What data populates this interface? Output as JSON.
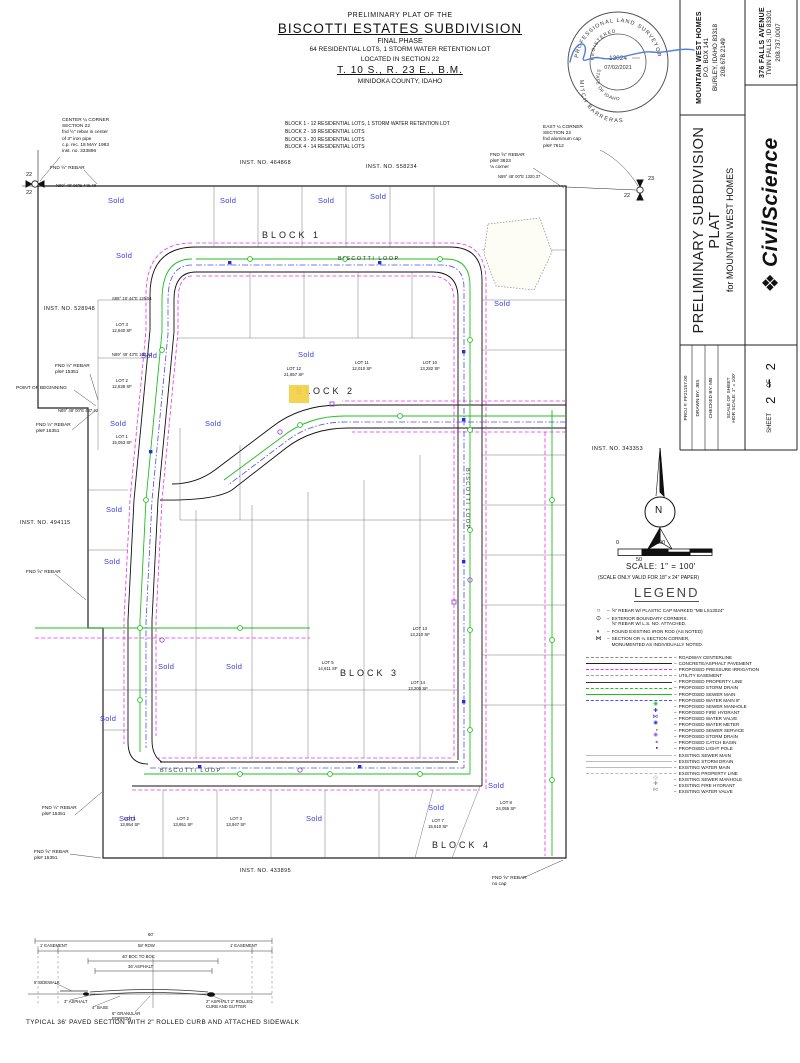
{
  "colors": {
    "sold_blue": "#3a3aee",
    "irrigation_magenta": "#e833e8",
    "sewer_green": "#1fbf1f",
    "water_blue": "#4d4de8",
    "storm_purple": "#9b4fd6",
    "existing_gray": "#bbbbbb",
    "highlight_yellow": "#f2d24b",
    "signature_blue": "#4f7fd9"
  },
  "title_block": {
    "prefix": "PRELIMINARY PLAT OF THE",
    "name": "BISCOTTI ESTATES SUBDIVISION",
    "phase": "FINAL PHASE",
    "lots_line": "64 RESIDENTIAL LOTS, 1 STORM WATER RETENTION LOT",
    "located_line": "LOCATED IN SECTION 22",
    "township_line": "T. 10 S., R. 23 E., B.M.",
    "county_line": "MINIDOKA COUNTY, IDAHO"
  },
  "blocks_summary": "BLOCK 1 - 12 RESIDENTIAL LOTS, 1 STORM WATER RETENTION LOT\nBLOCK 2 - 18 RESIDENTIAL LOTS\nBLOCK 3 - 20 RESIDENTIAL LOTS\nBLOCK 4 - 14 RESIDENTIAL LOTS",
  "seal": {
    "ring_top": "PROFESSIONAL LAND SURVEYOR",
    "registered": "REGISTERED",
    "number": "13024",
    "date": "07/02/2021",
    "state": "STATE OF IDAHO",
    "name": "MITCH BARRERAS"
  },
  "sidebar": {
    "client_name": "MOUNTAIN WEST HOMES",
    "client_addr1": "P.O. BOX 141",
    "client_addr2": "BURLEY, IDAHO 83318",
    "client_phone": "208.678.2149",
    "firm_addr1": "376 FALLS AVENUE",
    "firm_addr2": "TWIN FALLS, ID 83301",
    "firm_phone": "208.737.0007",
    "logo_text": "CivilScience",
    "sheet_title": "PRELIMINARY SUBDIVISION PLAT",
    "sheet_for": "for MOUNTAIN WEST HOMES",
    "proj": "PROJ #: FF21157.00",
    "drawn": "DRAWN BY: JBS",
    "checked": "CHECKED BY: MB",
    "scale1": "SCALE OF SHEET",
    "scale2": "HOR SCALE: 1\" = 100'",
    "sheet_word": "SHEET",
    "sheet_no": "2",
    "of_word": "OF",
    "sheet_total": "2"
  },
  "scale_bar": {
    "zero": "0",
    "fifty": "50",
    "hundred": "100",
    "scale_text": "SCALE: 1\" = 100'",
    "valid_text": "(SCALE ONLY VALID FOR 18\" x 24\" PAPER)"
  },
  "legend": {
    "title": "LEGEND",
    "markers": [
      {
        "icon": "○",
        "label": "⅝\" REBAR W/ PLASTIC CAP MARKED \"MB LS13024\""
      },
      {
        "icon": "⊙",
        "label": "EXTERIOR BOUNDARY CORNERS.\n⅝\" REBAR W/ L.S. NO. ATTACHED."
      },
      {
        "icon": "◐",
        "label": "FOUND EXISTING IRON ROD (AS NOTED)"
      },
      {
        "icon": "⋈",
        "label": "SECTION OR ¼ SECTION CORNER,\nMONUMENTED AS INDIVIDUALLY NOTED."
      }
    ],
    "lines": [
      {
        "sw": "sw-centerline",
        "label": "ROADWAY CENTERLINE"
      },
      {
        "sw": "sw-pavement",
        "label": "CONCRETE/ASPHALT PAVEMENT"
      },
      {
        "sw": "sw-pirr",
        "label": "PROPOSED PRESSURE IRRIGATION"
      },
      {
        "sw": "sw-easement",
        "label": "UTILITY EASEMENT"
      },
      {
        "sw": "sw-prop",
        "label": "PROPOSED PROPERTY LINE"
      },
      {
        "sw": "sw-storm",
        "label": "PROPOSED STORM DRAIN"
      },
      {
        "sw": "sw-sewer",
        "label": "PROPOSED SEWER MAIN"
      },
      {
        "sw": "sw-water",
        "label": "PROPOSED WATER MAIN 8\""
      },
      {
        "sw": "ic-smh",
        "label": "PROPOSED SEWER MANHOLE"
      },
      {
        "sw": "ic-hyd",
        "label": "PROPOSED FIRE HYDRANT"
      },
      {
        "sw": "ic-wv",
        "label": "PROPOSED WATER VALVE"
      },
      {
        "sw": "ic-wm",
        "label": "PROPOSED WATER METER"
      },
      {
        "sw": "ic-ss",
        "label": "PROPOSED SEWER SERVICE"
      },
      {
        "sw": "ic-stmh",
        "label": "PROPOSED STORM DRAIN"
      },
      {
        "sw": "ic-cb",
        "label": "PROPOSED CATCH BASIN"
      },
      {
        "sw": "ic-lp",
        "label": "PROPOSED LIGHT POLE"
      },
      {
        "sw": "sw-ex",
        "label": "EXISTING SEWER MAIN"
      },
      {
        "sw": "sw-ex",
        "label": "EXISTING STORM DRAIN"
      },
      {
        "sw": "sw-ex",
        "label": "EXISTING WATER MAIN"
      },
      {
        "sw": "sw-exd",
        "label": "EXISTING PROPERTY LINE"
      },
      {
        "sw": "ic-exmh",
        "label": "EXISTING SEWER MANHOLE"
      },
      {
        "sw": "ic-exhyd",
        "label": "EXISTING FIRE HYDRANT"
      },
      {
        "sw": "ic-exwv",
        "label": "EXISTING WATER VALVE"
      }
    ]
  },
  "map": {
    "labels": [
      {
        "text": "BISCOTTI LOOP",
        "x": 338,
        "y": 256,
        "cls": "street"
      },
      {
        "text": "BISCOTTI LOOP",
        "x": 463,
        "y": 468,
        "cls": "street-v"
      },
      {
        "text": "BISCOTTI LOOP",
        "x": 160,
        "y": 768,
        "cls": "street"
      },
      {
        "text": "BLOCK 1",
        "x": 262,
        "y": 230,
        "cls": "block"
      },
      {
        "text": "BLOCK 2",
        "x": 296,
        "y": 386,
        "cls": "block"
      },
      {
        "text": "BLOCK 3",
        "x": 340,
        "y": 668,
        "cls": "block"
      },
      {
        "text": "BLOCK 4",
        "x": 432,
        "y": 840,
        "cls": "block"
      },
      {
        "text": "INST. NO. 464868",
        "x": 240,
        "y": 160,
        "cls": "inst"
      },
      {
        "text": "INST. NO. 558234",
        "x": 366,
        "y": 164,
        "cls": "inst"
      },
      {
        "text": "INST. NO. 528948",
        "x": 44,
        "y": 306,
        "cls": "inst"
      },
      {
        "text": "INST. NO. 494115",
        "x": 20,
        "y": 520,
        "cls": "inst"
      },
      {
        "text": "INST. NO. 343353",
        "x": 592,
        "y": 446,
        "cls": "inst"
      },
      {
        "text": "INST. NO. 433895",
        "x": 240,
        "y": 868,
        "cls": "inst"
      },
      {
        "text": "Sold",
        "x": 108,
        "y": 196,
        "cls": "sold"
      },
      {
        "text": "Sold",
        "x": 220,
        "y": 196,
        "cls": "sold"
      },
      {
        "text": "Sold",
        "x": 318,
        "y": 196,
        "cls": "sold"
      },
      {
        "text": "Sold",
        "x": 370,
        "y": 192,
        "cls": "sold"
      },
      {
        "text": "Sold",
        "x": 116,
        "y": 251,
        "cls": "sold"
      },
      {
        "text": "Sold",
        "x": 494,
        "y": 299,
        "cls": "sold"
      },
      {
        "text": "Sold",
        "x": 298,
        "y": 350,
        "cls": "sold"
      },
      {
        "text": "Sold",
        "x": 141,
        "y": 351,
        "cls": "sold"
      },
      {
        "text": "Sold",
        "x": 110,
        "y": 419,
        "cls": "sold"
      },
      {
        "text": "Sold",
        "x": 205,
        "y": 419,
        "cls": "sold"
      },
      {
        "text": "Sold",
        "x": 106,
        "y": 505,
        "cls": "sold"
      },
      {
        "text": "Sold",
        "x": 104,
        "y": 557,
        "cls": "sold"
      },
      {
        "text": "Sold",
        "x": 158,
        "y": 662,
        "cls": "sold"
      },
      {
        "text": "Sold",
        "x": 226,
        "y": 662,
        "cls": "sold"
      },
      {
        "text": "Sold",
        "x": 100,
        "y": 714,
        "cls": "sold"
      },
      {
        "text": "Sold",
        "x": 119,
        "y": 814,
        "cls": "sold"
      },
      {
        "text": "Sold",
        "x": 306,
        "y": 814,
        "cls": "sold"
      },
      {
        "text": "Sold",
        "x": 428,
        "y": 803,
        "cls": "sold"
      },
      {
        "text": "Sold",
        "x": 488,
        "y": 781,
        "cls": "sold"
      },
      {
        "text": "LOT 3\n12,640 SF",
        "x": 112,
        "y": 322,
        "cls": "lot"
      },
      {
        "text": "LOT 2\n12,638 SF",
        "x": 112,
        "y": 378,
        "cls": "lot"
      },
      {
        "text": "LOT 1\n15,053 SF",
        "x": 112,
        "y": 434,
        "cls": "lot"
      },
      {
        "text": "LOT 12\n21,857 SF",
        "x": 284,
        "y": 366,
        "cls": "lot"
      },
      {
        "text": "LOT 11\n12,010 SF",
        "x": 352,
        "y": 360,
        "cls": "lot"
      },
      {
        "text": "LOT 10\n13,282 SF",
        "x": 420,
        "y": 360,
        "cls": "lot"
      },
      {
        "text": "LOT 5\n14,611 SF",
        "x": 318,
        "y": 660,
        "cls": "lot"
      },
      {
        "text": "LOT 13\n13,210 SF",
        "x": 410,
        "y": 626,
        "cls": "lot"
      },
      {
        "text": "LOT 14\n13,200 SF",
        "x": 408,
        "y": 680,
        "cls": "lot"
      },
      {
        "text": "LOT 1\n13,954 SF",
        "x": 120,
        "y": 816,
        "cls": "lot"
      },
      {
        "text": "LOT 2\n13,951 SF",
        "x": 173,
        "y": 816,
        "cls": "lot"
      },
      {
        "text": "LOT 3\n13,947 SF",
        "x": 226,
        "y": 816,
        "cls": "lot"
      },
      {
        "text": "LOT 7\n15,510 SF",
        "x": 428,
        "y": 818,
        "cls": "lot"
      },
      {
        "text": "LOT 8\n24,055 SF",
        "x": 496,
        "y": 800,
        "cls": "lot"
      },
      {
        "text": "N89° 48' 06\"E  446.48",
        "x": 56,
        "y": 183,
        "cls": "bearing"
      },
      {
        "text": "N89° 48' 00\"E  1320.37",
        "x": 498,
        "y": 174,
        "cls": "bearing"
      },
      {
        "text": "N89° 48' 00\"E  437.42",
        "x": 58,
        "y": 408,
        "cls": "bearing"
      },
      {
        "text": "S88° 18' 44\"E  125.51",
        "x": 112,
        "y": 296,
        "cls": "bearing"
      },
      {
        "text": "N89° 49' 43\"E  124.82",
        "x": 112,
        "y": 352,
        "cls": "bearing"
      },
      {
        "text": "CENTER ¼ CORNER\nSECTION 22\nfnd ½\" rebar in center\nof 3\" iron pipe\nc.p. rec. 18 MAY 1983\ninst. no. 333896",
        "x": 62,
        "y": 118,
        "cls": "note"
      },
      {
        "text": "FND ½\" REBAR",
        "x": 50,
        "y": 166,
        "cls": "note"
      },
      {
        "text": "EAST ¼ CORNER\nSECTION 22\nfnd aluminum cap\npls# 7612",
        "x": 543,
        "y": 125,
        "cls": "note"
      },
      {
        "text": "FND ⅝\" REBAR\npls# 3623\n⅛ corner",
        "x": 490,
        "y": 153,
        "cls": "note"
      },
      {
        "text": "FND ½\" REBAR\npls# 15351",
        "x": 55,
        "y": 364,
        "cls": "note"
      },
      {
        "text": "POINT OF BEGINNING",
        "x": 16,
        "y": 386,
        "cls": "note"
      },
      {
        "text": "FND ½\" REBAR\npls# 15351",
        "x": 36,
        "y": 423,
        "cls": "note"
      },
      {
        "text": "FND ⅝\" REBAR",
        "x": 26,
        "y": 570,
        "cls": "note"
      },
      {
        "text": "FND ½\" REBAR\npls# 15351",
        "x": 42,
        "y": 806,
        "cls": "note"
      },
      {
        "text": "FND ⅝\" REBAR\npls# 15351",
        "x": 34,
        "y": 850,
        "cls": "note"
      },
      {
        "text": "FND ⅝\" REBAR\nno cap",
        "x": 492,
        "y": 876,
        "cls": "note"
      },
      {
        "text": "22",
        "x": 26,
        "y": 172,
        "cls": "tick"
      },
      {
        "text": "22",
        "x": 26,
        "y": 190,
        "cls": "tick"
      },
      {
        "text": "23",
        "x": 648,
        "y": 176,
        "cls": "tick"
      },
      {
        "text": "22",
        "x": 624,
        "y": 193,
        "cls": "tick"
      },
      {
        "text": "N",
        "x": 655,
        "y": 505,
        "cls": "north-n"
      },
      {
        "text": "0",
        "x": 616,
        "y": 540,
        "cls": "tick"
      },
      {
        "text": "100",
        "x": 656,
        "y": 540,
        "cls": "tick"
      },
      {
        "text": "50",
        "x": 636,
        "y": 557,
        "cls": "tick"
      },
      {
        "text": "SCALE: 1\" = 100'",
        "x": 626,
        "y": 562,
        "cls": "scale-main"
      },
      {
        "text": "(SCALE ONLY VALID FOR 18\" x 24\" PAPER)",
        "x": 598,
        "y": 575,
        "cls": "scale-sub"
      },
      {
        "text": "60'",
        "x": 148,
        "y": 932,
        "cls": "xs"
      },
      {
        "text": "1' EASEMENT",
        "x": 40,
        "y": 943,
        "cls": "xs"
      },
      {
        "text": "58' ROW",
        "x": 138,
        "y": 943,
        "cls": "xs"
      },
      {
        "text": "1' EASEMENT",
        "x": 230,
        "y": 943,
        "cls": "xs"
      },
      {
        "text": "40' BOC TO BOC",
        "x": 122,
        "y": 954,
        "cls": "xs"
      },
      {
        "text": "36' ASPHALT",
        "x": 128,
        "y": 964,
        "cls": "xs"
      },
      {
        "text": "5' SIDEWALK",
        "x": 34,
        "y": 980,
        "cls": "xs"
      },
      {
        "text": "3\" ASPHALT",
        "x": 64,
        "y": 999,
        "cls": "xs"
      },
      {
        "text": "4\" BASE",
        "x": 92,
        "y": 1005,
        "cls": "xs"
      },
      {
        "text": "6\" GRANULAR\nBORROW",
        "x": 112,
        "y": 1011,
        "cls": "xs"
      },
      {
        "text": "2\" ASPHALT 2\" ROLLED\nCURB AND GUTTER",
        "x": 206,
        "y": 999,
        "cls": "xs"
      },
      {
        "text": "TYPICAL 36' PAVED SECTION WITH 2\" ROLLED CURB AND ATTACHED SIDEWALK",
        "x": 26,
        "y": 1019,
        "cls": "xs-caption"
      }
    ]
  }
}
